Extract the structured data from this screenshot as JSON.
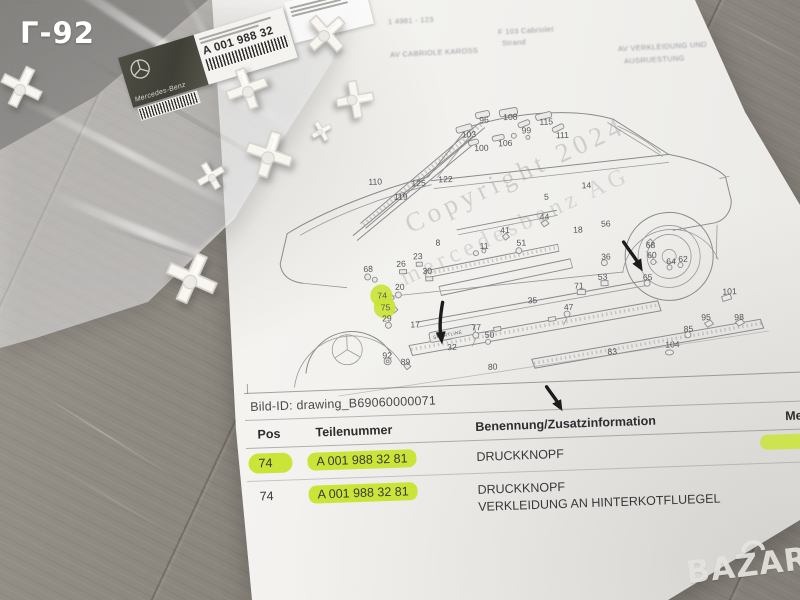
{
  "colors": {
    "highlight": "#cbe438",
    "paper": "#f2f1ed",
    "wood": "#8e8983",
    "label_dark": "#4c4c42"
  },
  "overlay": {
    "corner_tag": "Г-92",
    "store_logo": "BAZAR"
  },
  "bag": {
    "label": {
      "brand": "Mercedes-Benz",
      "part_number": "A 001 988 32"
    }
  },
  "paper": {
    "header_faint": {
      "left_line1": "1 4981 - 123",
      "left_line2": "AV CABRIOLE KAROSS",
      "center_line1": "F 103 Cabriolet",
      "center_line2": "Strand",
      "right_line1": "AV VERKLEIDUNG UND",
      "right_line2": "AUSRUESTUNG"
    },
    "watermarks": {
      "line1": "Copyright 2024",
      "line2": "mercedesbenz AG"
    },
    "bild_id": {
      "label": "Bild-ID:",
      "value": "drawing_B69060000071"
    },
    "diagram": {
      "badge_text": "SPORTLINE",
      "highlighted_positions": [
        "74",
        "75"
      ],
      "labels": [
        {
          "n": "110",
          "x": 145,
          "y": 102
        },
        {
          "n": "119",
          "x": 170,
          "y": 118
        },
        {
          "n": "125",
          "x": 188,
          "y": 105
        },
        {
          "n": "122",
          "x": 215,
          "y": 102
        },
        {
          "n": "103",
          "x": 240,
          "y": 58
        },
        {
          "n": "96",
          "x": 258,
          "y": 44
        },
        {
          "n": "108",
          "x": 282,
          "y": 42
        },
        {
          "n": "99",
          "x": 300,
          "y": 56
        },
        {
          "n": "115",
          "x": 318,
          "y": 48
        },
        {
          "n": "111",
          "x": 334,
          "y": 62
        },
        {
          "n": "100",
          "x": 252,
          "y": 72
        },
        {
          "n": "106",
          "x": 276,
          "y": 68
        },
        {
          "n": "5",
          "x": 320,
          "y": 123
        },
        {
          "n": "14",
          "x": 358,
          "y": 113
        },
        {
          "n": "44",
          "x": 315,
          "y": 143
        },
        {
          "n": "68",
          "x": 137,
          "y": 189
        },
        {
          "n": "26",
          "x": 170,
          "y": 185
        },
        {
          "n": "23",
          "x": 187,
          "y": 178
        },
        {
          "n": "8",
          "x": 210,
          "y": 165
        },
        {
          "n": "20",
          "x": 168,
          "y": 208
        },
        {
          "n": "30",
          "x": 196,
          "y": 193
        },
        {
          "n": "11",
          "x": 254,
          "y": 170
        },
        {
          "n": "41",
          "x": 275,
          "y": 155
        },
        {
          "n": "51",
          "x": 291,
          "y": 168
        },
        {
          "n": "74",
          "x": 150,
          "y": 216
        },
        {
          "n": "75",
          "x": 153,
          "y": 228
        },
        {
          "n": "29",
          "x": 154,
          "y": 239
        },
        {
          "n": "17",
          "x": 182,
          "y": 246
        },
        {
          "n": "92",
          "x": 153,
          "y": 276
        },
        {
          "n": "89",
          "x": 171,
          "y": 283
        },
        {
          "n": "35",
          "x": 300,
          "y": 226
        },
        {
          "n": "77",
          "x": 243,
          "y": 251
        },
        {
          "n": "50",
          "x": 256,
          "y": 259
        },
        {
          "n": "32",
          "x": 218,
          "y": 270
        },
        {
          "n": "18",
          "x": 348,
          "y": 157
        },
        {
          "n": "56",
          "x": 376,
          "y": 152
        },
        {
          "n": "36",
          "x": 375,
          "y": 185
        },
        {
          "n": "53",
          "x": 371,
          "y": 205
        },
        {
          "n": "71",
          "x": 347,
          "y": 213
        },
        {
          "n": "47",
          "x": 336,
          "y": 234
        },
        {
          "n": "80",
          "x": 258,
          "y": 291
        },
        {
          "n": "83",
          "x": 378,
          "y": 280
        },
        {
          "n": "68",
          "x": 420,
          "y": 175
        },
        {
          "n": "60",
          "x": 421,
          "y": 185
        },
        {
          "n": "64",
          "x": 440,
          "y": 192
        },
        {
          "n": "62",
          "x": 452,
          "y": 190
        },
        {
          "n": "65",
          "x": 416,
          "y": 207
        },
        {
          "n": "101",
          "x": 495,
          "y": 224
        },
        {
          "n": "95",
          "x": 473,
          "y": 249
        },
        {
          "n": "98",
          "x": 506,
          "y": 250
        },
        {
          "n": "85",
          "x": 455,
          "y": 260
        },
        {
          "n": "104",
          "x": 436,
          "y": 275
        }
      ]
    },
    "table": {
      "headers": [
        "Pos",
        "Teilenummer",
        "Benennung/Zusatzinformation",
        "Me"
      ],
      "rows": [
        {
          "pos": "74",
          "teilenummer": "A 001 988 32 81",
          "benennung": "DRUCKKNOPF",
          "zusatz": "",
          "highlight_pos": true,
          "highlight_teilenummer": true
        },
        {
          "pos": "74",
          "teilenummer": "A 001 988 32 81",
          "benennung": "DRUCKKNOPF",
          "zusatz": "VERKLEIDUNG AN HINTERKOTFLUEGEL",
          "highlight_pos": false,
          "highlight_teilenummer": true
        }
      ]
    }
  }
}
